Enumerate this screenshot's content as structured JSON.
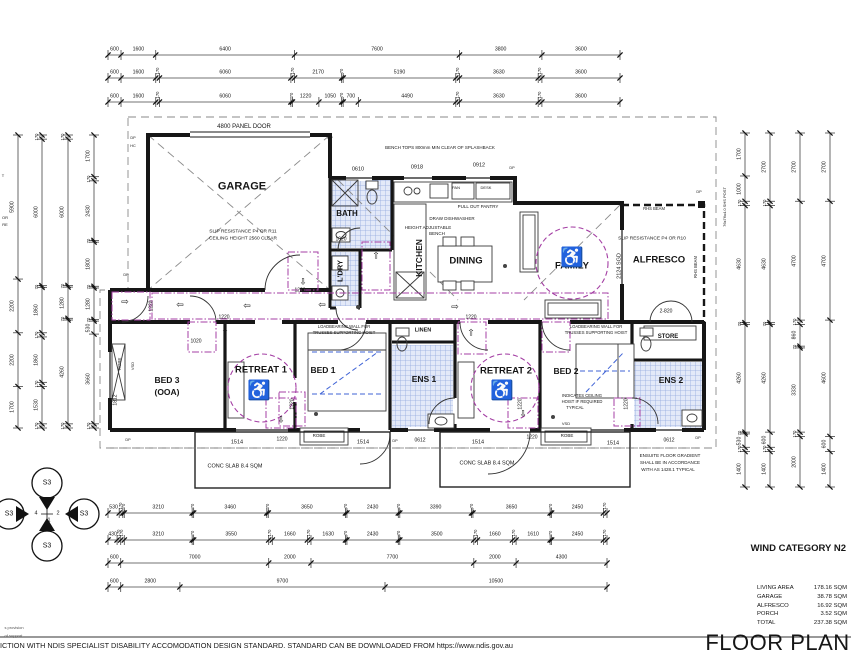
{
  "drawing": {
    "title": "FLOOR PLAN",
    "wind_category": "WIND CATEGORY N2",
    "area_schedule": [
      {
        "label": "LIVING AREA",
        "value": "178.16 SQM"
      },
      {
        "label": "GARAGE",
        "value": "38.78 SQM"
      },
      {
        "label": "ALFRESCO",
        "value": "16.92 SQM"
      },
      {
        "label": "PORCH",
        "value": "3.52 SQM"
      },
      {
        "label": "TOTAL",
        "value": "237.38 SQM"
      }
    ],
    "footer_note": "ICTION WITH NDIS SPECIALIST DISABILITY ACCOMODATION DESIGN STANDARD. STANDARD CAN BE DOWNLOADED FROM https://www.ndis.gov.au",
    "accent_purple": "#a43fa4",
    "hoist_blue": "#3f63d6",
    "wet_area_fill": "#e3e9f8"
  },
  "rooms": [
    {
      "t": "GARAGE",
      "x": 242,
      "y": 187,
      "fs": 11
    },
    {
      "t": "BATH",
      "x": 347,
      "y": 214,
      "fs": 8
    },
    {
      "t": "L'DRY",
      "x": 340,
      "y": 271,
      "fs": 7.5,
      "r": 1
    },
    {
      "t": "KITCHEN",
      "x": 419,
      "y": 258,
      "fs": 8.5,
      "r": 1
    },
    {
      "t": "DINING",
      "x": 466,
      "y": 261,
      "fs": 9.5
    },
    {
      "t": "FAMILY",
      "x": 572,
      "y": 266,
      "fs": 9.5
    },
    {
      "t": "ALFRESCO",
      "x": 659,
      "y": 260,
      "fs": 9.5
    },
    {
      "t": "STORE",
      "x": 668,
      "y": 337,
      "fs": 6
    },
    {
      "t": "BED 3",
      "x": 167,
      "y": 380,
      "fs": 8.5
    },
    {
      "t": "(OOA)",
      "x": 167,
      "y": 392,
      "fs": 8.5
    },
    {
      "t": "RETREAT 1",
      "x": 261,
      "y": 370,
      "fs": 9.5
    },
    {
      "t": "BED 1",
      "x": 323,
      "y": 370,
      "fs": 8.5
    },
    {
      "t": "ENS 1",
      "x": 424,
      "y": 379,
      "fs": 8.5
    },
    {
      "t": "RETREAT 2",
      "x": 506,
      "y": 371,
      "fs": 9.5
    },
    {
      "t": "BED 2",
      "x": 566,
      "y": 371,
      "fs": 8.5
    },
    {
      "t": "ENS 2",
      "x": 671,
      "y": 380,
      "fs": 8.5
    },
    {
      "t": "LINEN",
      "x": 423,
      "y": 331,
      "fs": 5.5
    }
  ],
  "annotations": [
    {
      "t": "4800 PANEL DOOR",
      "x": 244,
      "y": 127,
      "fs": 6
    },
    {
      "t": "SLIP RESISTANCE P4 OR R11",
      "x": 243,
      "y": 233,
      "fs": 4.8
    },
    {
      "t": "CEILING HEIGHT 2560 CLEAR",
      "x": 243,
      "y": 240,
      "fs": 4.8
    },
    {
      "t": "BENCH TOPS 800mm MIN CLEAR OF SPLASHBACK",
      "x": 440,
      "y": 148,
      "fs": 4.5
    },
    {
      "t": "0610",
      "x": 358,
      "y": 170,
      "fs": 5.5
    },
    {
      "t": "0918",
      "x": 417,
      "y": 168,
      "fs": 5.5
    },
    {
      "t": "0912",
      "x": 479,
      "y": 166,
      "fs": 5.5
    },
    {
      "t": "PAN",
      "x": 456,
      "y": 188,
      "fs": 4
    },
    {
      "t": "DESK",
      "x": 486,
      "y": 188,
      "fs": 4
    },
    {
      "t": "PULL OUT PANTRY",
      "x": 478,
      "y": 207,
      "fs": 4.5
    },
    {
      "t": "DRAW DISHWASHER",
      "x": 452,
      "y": 219,
      "fs": 4.5
    },
    {
      "t": "HEIGHT ADJUSTABLE",
      "x": 428,
      "y": 228,
      "fs": 4.5
    },
    {
      "t": "BENCH",
      "x": 437,
      "y": 234,
      "fs": 4.5
    },
    {
      "t": "1020",
      "x": 341,
      "y": 240,
      "fs": 5
    },
    {
      "t": "SLIP RESISTANCE P4 OR R10",
      "x": 652,
      "y": 240,
      "fs": 4.8
    },
    {
      "t": "2124 SGD",
      "x": 620,
      "y": 266,
      "fs": 5.5,
      "r": 1
    },
    {
      "t": "RHS BEAM",
      "x": 654,
      "y": 209,
      "fs": 4.2
    },
    {
      "t": "RHS BEAM",
      "x": 696,
      "y": 267,
      "fs": 4.2,
      "r": 1
    },
    {
      "t": "76x76x4.0 SHS POST",
      "x": 725,
      "y": 207,
      "fs": 4,
      "r": 1
    },
    {
      "t": "2-820",
      "x": 666,
      "y": 312,
      "fs": 5
    },
    {
      "t": "1220",
      "x": 300,
      "y": 291,
      "fs": 5
    },
    {
      "t": "1220",
      "x": 224,
      "y": 318,
      "fs": 5
    },
    {
      "t": "1220",
      "x": 471,
      "y": 318,
      "fs": 5
    },
    {
      "t": "1220",
      "x": 152,
      "y": 306,
      "fs": 5,
      "r": 1
    },
    {
      "t": "1220",
      "x": 293,
      "y": 404,
      "fs": 5,
      "r": 1
    },
    {
      "t": "1220",
      "x": 521,
      "y": 404,
      "fs": 5,
      "r": 1
    },
    {
      "t": "1220",
      "x": 627,
      "y": 404,
      "fs": 5,
      "r": 1
    },
    {
      "t": "1220",
      "x": 282,
      "y": 440,
      "fs": 5
    },
    {
      "t": "1220",
      "x": 532,
      "y": 438,
      "fs": 5
    },
    {
      "t": "1020",
      "x": 196,
      "y": 342,
      "fs": 5
    },
    {
      "t": "1812",
      "x": 116,
      "y": 400,
      "fs": 5,
      "r": 1
    },
    {
      "t": "ROBE",
      "x": 120,
      "y": 364,
      "fs": 4.5,
      "r": 1
    },
    {
      "t": "VSD",
      "x": 133,
      "y": 366,
      "fs": 4,
      "r": 1
    },
    {
      "t": "VSD",
      "x": 566,
      "y": 424,
      "fs": 4
    },
    {
      "t": "LOADBEARING WALL FOR",
      "x": 344,
      "y": 327,
      "fs": 4.2
    },
    {
      "t": "TRUSSES SUPPORTING HOIST",
      "x": 344,
      "y": 333,
      "fs": 4.2
    },
    {
      "t": "LOADBEARING WALL FOR",
      "x": 596,
      "y": 327,
      "fs": 4.2
    },
    {
      "t": "TRUSSES SUPPORTING HOIST",
      "x": 596,
      "y": 333,
      "fs": 4.2
    },
    {
      "t": "INDICATES CEILING",
      "x": 582,
      "y": 396,
      "fs": 4.2
    },
    {
      "t": "HOIST IF REQUIRED",
      "x": 582,
      "y": 402,
      "fs": 4.2
    },
    {
      "t": "TYPICAL",
      "x": 575,
      "y": 408,
      "fs": 4.2
    },
    {
      "t": "ENSUITE FLOOR GRADIENT",
      "x": 670,
      "y": 456,
      "fs": 4.5
    },
    {
      "t": "SHALL BE IN ACCORDANCE",
      "x": 670,
      "y": 463,
      "fs": 4.5
    },
    {
      "t": "WITH AS 1428.1 TYPICAL",
      "x": 668,
      "y": 470,
      "fs": 4.5
    },
    {
      "t": "CONC SLAB 8.4 SQM",
      "x": 235,
      "y": 467,
      "fs": 5.5
    },
    {
      "t": "CONC SLAB 8.4 SQM",
      "x": 487,
      "y": 464,
      "fs": 5.5
    },
    {
      "t": "ROBE",
      "x": 319,
      "y": 436,
      "fs": 4.5
    },
    {
      "t": "ROBE",
      "x": 567,
      "y": 436,
      "fs": 4.5
    },
    {
      "t": "0612",
      "x": 420,
      "y": 441,
      "fs": 5
    },
    {
      "t": "0612",
      "x": 669,
      "y": 441,
      "fs": 5
    },
    {
      "t": "1514",
      "x": 237,
      "y": 443,
      "fs": 5.5
    },
    {
      "t": "1514",
      "x": 363,
      "y": 443,
      "fs": 5.5
    },
    {
      "t": "1514",
      "x": 478,
      "y": 443,
      "fs": 5.5
    },
    {
      "t": "1514",
      "x": 613,
      "y": 444,
      "fs": 5.5
    },
    {
      "t": "DP",
      "x": 133,
      "y": 139,
      "fs": 3.8
    },
    {
      "t": "HC",
      "x": 133,
      "y": 147,
      "fs": 3.8
    },
    {
      "t": "DP",
      "x": 330,
      "y": 139,
      "fs": 3.8
    },
    {
      "t": "DP",
      "x": 512,
      "y": 169,
      "fs": 3.8
    },
    {
      "t": "DP",
      "x": 699,
      "y": 193,
      "fs": 3.8
    },
    {
      "t": "DP",
      "x": 126,
      "y": 276,
      "fs": 3.8
    },
    {
      "t": "DP",
      "x": 128,
      "y": 441,
      "fs": 3.8
    },
    {
      "t": "DP",
      "x": 395,
      "y": 442,
      "fs": 3.8
    },
    {
      "t": "DP",
      "x": 698,
      "y": 439,
      "fs": 3.8
    },
    {
      "t": "T",
      "x": 3,
      "y": 176,
      "fs": 4
    },
    {
      "t": "OR",
      "x": 5,
      "y": 218,
      "fs": 4
    },
    {
      "t": "RE",
      "x": 5,
      "y": 225,
      "fs": 4
    },
    {
      "t": "S3",
      "x": 47,
      "y": 483,
      "fs": 7
    },
    {
      "t": "S3",
      "x": 9,
      "y": 514,
      "fs": 7
    },
    {
      "t": "S3",
      "x": 84,
      "y": 514,
      "fs": 7
    },
    {
      "t": "S3",
      "x": 47,
      "y": 546,
      "fs": 7
    },
    {
      "t": "3",
      "x": 47,
      "y": 505,
      "fs": 5.5
    },
    {
      "t": "4",
      "x": 36,
      "y": 514,
      "fs": 5.5
    },
    {
      "t": "2",
      "x": 58,
      "y": 514,
      "fs": 5.5
    },
    {
      "t": "1",
      "x": 49,
      "y": 521,
      "fs": 5.5
    },
    {
      "t": "s provision",
      "x": 14,
      "y": 628,
      "fs": 4,
      "c": "#555"
    },
    {
      "t": "of support.",
      "x": 14,
      "y": 636,
      "fs": 4,
      "c": "#555"
    }
  ],
  "path_arrows": [
    {
      "g": "⇩",
      "x": 303,
      "y": 282
    },
    {
      "g": "⇨",
      "x": 125,
      "y": 302
    },
    {
      "g": "⇦",
      "x": 180,
      "y": 305
    },
    {
      "g": "⇦",
      "x": 247,
      "y": 306
    },
    {
      "g": "⇦",
      "x": 322,
      "y": 305
    },
    {
      "g": "⇨",
      "x": 455,
      "y": 307
    },
    {
      "g": "⇧",
      "x": 376,
      "y": 256
    },
    {
      "g": "⇧",
      "x": 225,
      "y": 333
    },
    {
      "g": "⇧",
      "x": 471,
      "y": 333
    },
    {
      "g": "⇩",
      "x": 281,
      "y": 420
    },
    {
      "g": "⇩",
      "x": 523,
      "y": 414
    }
  ],
  "wheelchair_symbols": [
    {
      "x": 572,
      "y": 258
    },
    {
      "x": 259,
      "y": 391
    },
    {
      "x": 502,
      "y": 391
    }
  ],
  "dim_chains": [
    {
      "o": "h",
      "y": 55,
      "x0": 108,
      "x1": 620,
      "v": [
        "600",
        "1600",
        "6400",
        "7600",
        "3800",
        "3600"
      ]
    },
    {
      "o": "h",
      "y": 78,
      "x0": 108,
      "x1": 620,
      "v": [
        "600",
        "1600",
        "170",
        "6060",
        "170",
        "2170",
        "70",
        "5190",
        "170",
        "3630",
        "170",
        "3600"
      ]
    },
    {
      "o": "h",
      "y": 102,
      "x0": 108,
      "x1": 620,
      "v": [
        "600",
        "1600",
        "170",
        "6060",
        "70",
        "1220",
        "1050",
        "70",
        "700",
        "4490",
        "170",
        "3630",
        "170",
        "3600"
      ]
    },
    {
      "o": "h",
      "y": 513,
      "x0": 108,
      "x1": 607,
      "v": [
        "530",
        "170",
        "70",
        "3210",
        "70",
        "3460",
        "70",
        "3650",
        "70",
        "2430",
        "70",
        "3390",
        "70",
        "3650",
        "70",
        "2450",
        "170"
      ]
    },
    {
      "o": "h",
      "y": 540,
      "x0": 108,
      "x1": 607,
      "v": [
        "430",
        "170",
        "170",
        "3210",
        "70",
        "3550",
        "170",
        "1660",
        "170",
        "1630",
        "70",
        "2430",
        "70",
        "3500",
        "170",
        "1660",
        "170",
        "1610",
        "70",
        "2450",
        "170"
      ]
    },
    {
      "o": "h",
      "y": 563,
      "x0": 108,
      "x1": 607,
      "v": [
        "600",
        "7000",
        "2000",
        "7700",
        "2000",
        "4300"
      ]
    },
    {
      "o": "h",
      "y": 587,
      "x0": 108,
      "x1": 607,
      "v": [
        "600",
        "2800",
        "9700",
        "10500"
      ]
    },
    {
      "o": "v",
      "x": 18,
      "y0": 135,
      "y1": 428,
      "v": [
        "5900",
        "2200",
        "2200",
        "1700"
      ]
    },
    {
      "o": "v",
      "x": 42,
      "y0": 135,
      "y1": 428,
      "v": [
        "170",
        "6000",
        "70",
        "1860",
        "170",
        "1860",
        "170",
        "1530",
        "170"
      ]
    },
    {
      "o": "v",
      "x": 68,
      "y0": 135,
      "y1": 428,
      "v": [
        "170",
        "6000",
        "70",
        "1280",
        "70",
        "4260",
        "170"
      ]
    },
    {
      "o": "v",
      "x": 94,
      "y0": 135,
      "y1": 428,
      "v": [
        "1700",
        "170",
        "2430",
        "70",
        "1800",
        "70",
        "1280",
        "70",
        "530",
        "3660",
        "170"
      ]
    },
    {
      "o": "v",
      "x": 745,
      "y0": 133,
      "y1": 487,
      "v": [
        "1700",
        "1000",
        "170",
        "4630",
        "70",
        "4260",
        "70",
        "530",
        "170",
        "1400"
      ]
    },
    {
      "o": "v",
      "x": 770,
      "y0": 133,
      "y1": 487,
      "v": [
        "2700",
        "170",
        "4630",
        "70",
        "4260",
        "600",
        "170",
        "1400"
      ]
    },
    {
      "o": "v",
      "x": 800,
      "y0": 133,
      "y1": 487,
      "v": [
        "2700",
        "4700",
        "170",
        "860",
        "70",
        "3330",
        "170",
        "2000"
      ]
    },
    {
      "o": "v",
      "x": 830,
      "y0": 133,
      "y1": 487,
      "v": [
        "2700",
        "4700",
        "4600",
        "600",
        "1400"
      ]
    }
  ]
}
